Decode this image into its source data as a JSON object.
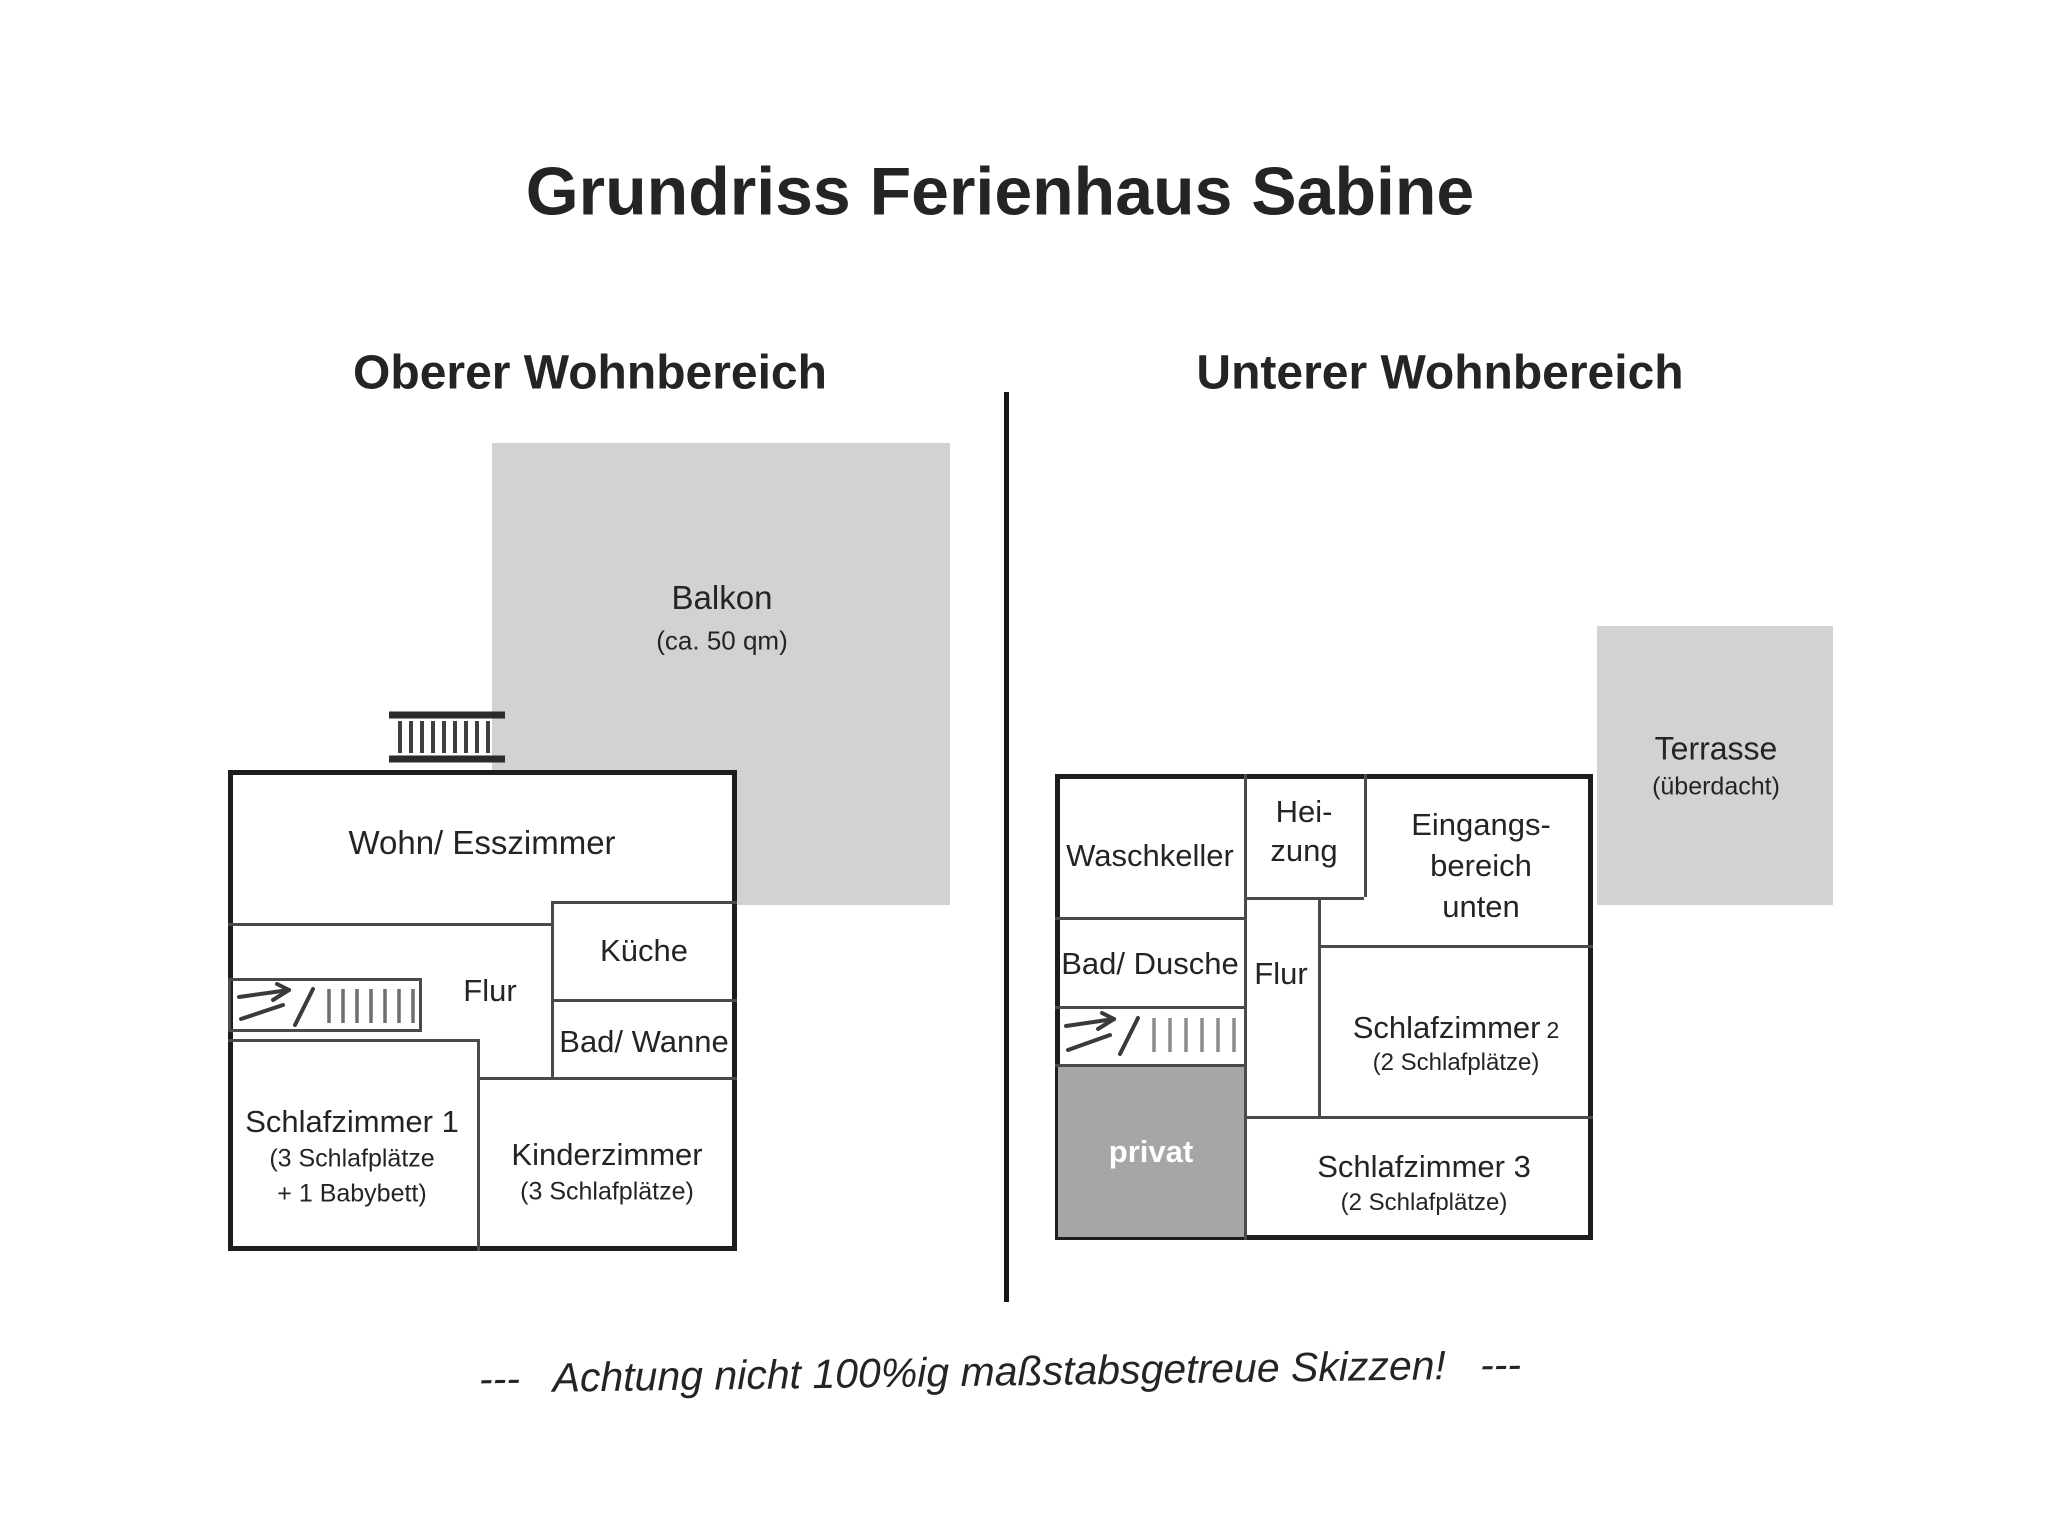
{
  "title": "Grundriss Ferienhaus Sabine",
  "sections": {
    "upper": {
      "heading": "Oberer Wohnbereich"
    },
    "lower": {
      "heading": "Unterer Wohnbereich"
    }
  },
  "colors": {
    "outdoor_area": "#d2d2d2",
    "private_area": "#a6a6a6",
    "outer_wall": "#1d1d1d",
    "inner_wall": "#4a4a4a",
    "text": "#242424",
    "privat_text": "#ffffff"
  },
  "upper_plan": {
    "balkon": {
      "label": "Balkon",
      "size_note": "(ca. 50 qm)"
    },
    "rooms": {
      "wohn_esszimmer": {
        "label": "Wohn/ Esszimmer"
      },
      "kueche": {
        "label": "Küche"
      },
      "flur": {
        "label": "Flur"
      },
      "bad_wanne": {
        "label": "Bad/ Wanne"
      },
      "schlafzimmer1": {
        "label": "Schlafzimmer 1",
        "note1": "(3 Schlafplätze",
        "note2": "+ 1 Babybett)"
      },
      "kinderzimmer": {
        "label": "Kinderzimmer",
        "note": "(3 Schlafplätze)"
      }
    }
  },
  "lower_plan": {
    "terrasse": {
      "label": "Terrasse",
      "size_note": "(überdacht)"
    },
    "rooms": {
      "waschkeller": {
        "label": "Waschkeller"
      },
      "heizung": {
        "line1": "Hei-",
        "line2": "zung"
      },
      "eingangsbereich": {
        "line1": "Eingangs-",
        "line2": "bereich",
        "line3": "unten"
      },
      "bad_dusche": {
        "label": "Bad/ Dusche"
      },
      "flur": {
        "label": "Flur"
      },
      "schlafzimmer2": {
        "label": "Schlafzimmer",
        "num": "2",
        "note": "(2 Schlafplätze)"
      },
      "privat": {
        "label": "privat"
      },
      "schlafzimmer3": {
        "label": "Schlafzimmer 3",
        "note": "(2 Schlafplätze)"
      }
    }
  },
  "footer": {
    "text": "---   Achtung nicht 100%ig maßstabsgetreue Skizzen!   ---"
  }
}
